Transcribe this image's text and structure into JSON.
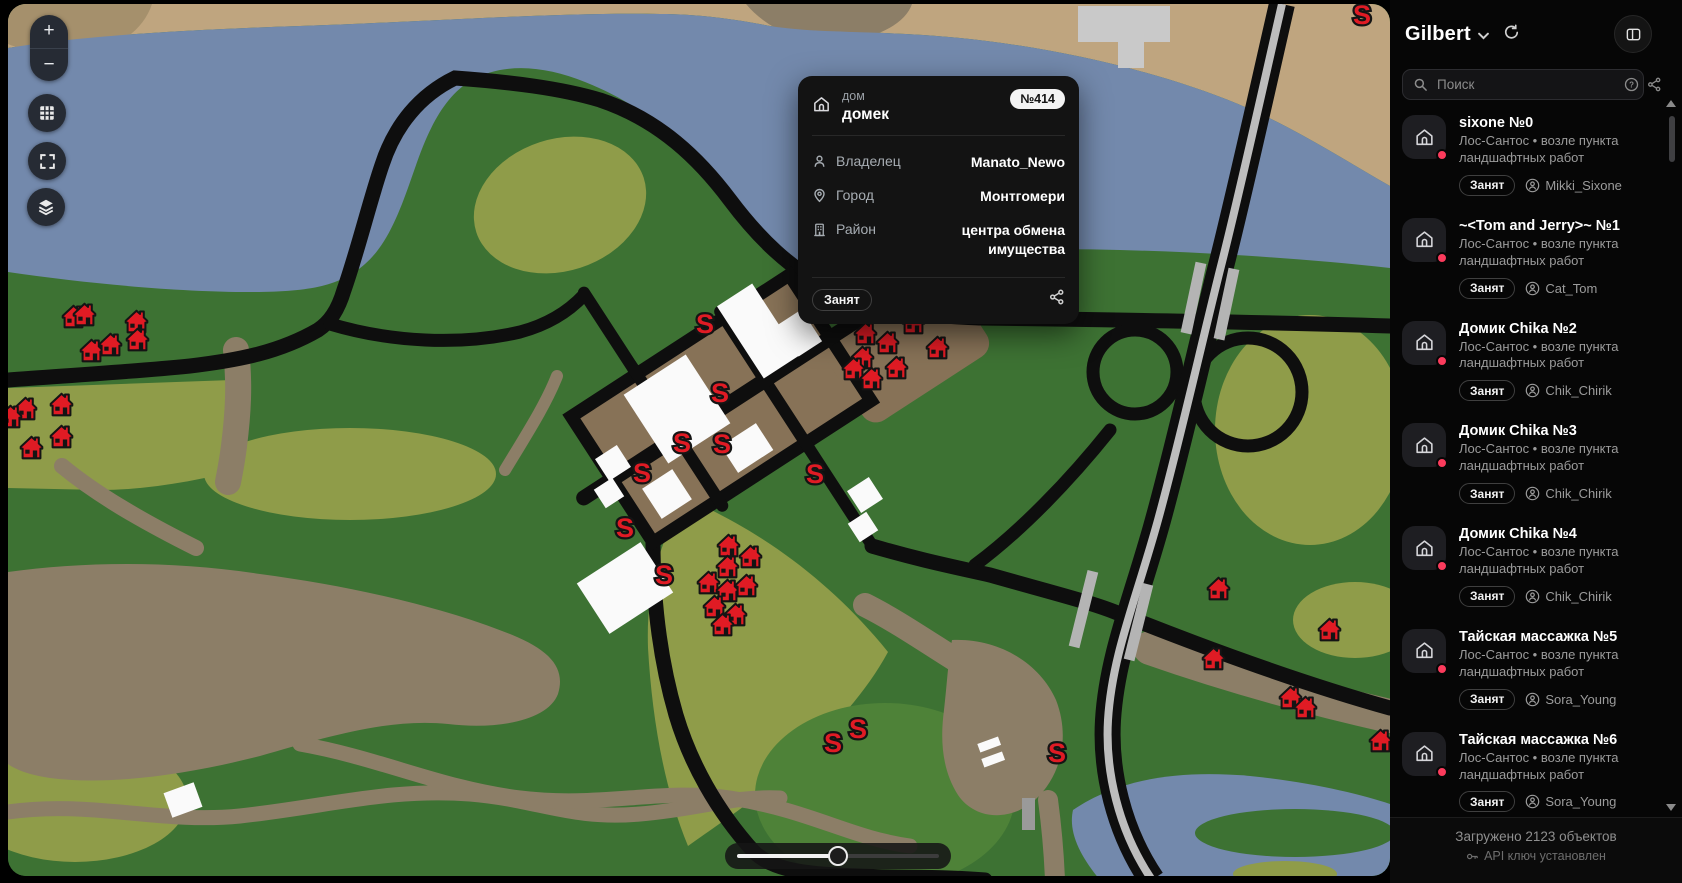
{
  "map": {
    "controls": {
      "zoom_in": "+",
      "zoom_out": "−",
      "grid_icon": "grid-icon",
      "fullscreen_icon": "fullscreen-icon",
      "layers_icon": "layers-icon"
    },
    "slider": {
      "progress_pct": 50
    },
    "colors": {
      "c-green": "#3d7233",
      "c-green2": "#4e8238",
      "c-olive": "#8f9c49",
      "c-water": "#7389ac",
      "c-tan": "#bfa57f",
      "c-tan2": "#a5906c",
      "c-dirt": "#8c7e67",
      "c-town": "#877257",
      "c-road": "#0e0e0e",
      "c-hwy": "#bdbdbd",
      "c-gray-bld": "#c9c9c9",
      "c-white-bld": "#fafafa",
      "c-red": "#e01b24",
      "c-dot": "#fb3b5c"
    },
    "s_label": "S",
    "s_markers": [
      [
        705,
        323
      ],
      [
        720,
        392
      ],
      [
        682,
        442
      ],
      [
        722,
        443
      ],
      [
        642,
        472
      ],
      [
        815,
        473
      ],
      [
        625,
        527
      ],
      [
        664,
        574
      ],
      [
        833,
        742
      ],
      [
        858,
        728
      ],
      [
        1057,
        752
      ],
      [
        1362,
        14
      ]
    ],
    "houses": [
      [
        73,
        316
      ],
      [
        84,
        314
      ],
      [
        136,
        321
      ],
      [
        91,
        350
      ],
      [
        110,
        344
      ],
      [
        137,
        339
      ],
      [
        25,
        408
      ],
      [
        61,
        404
      ],
      [
        61,
        436
      ],
      [
        31,
        447
      ],
      [
        10,
        416
      ],
      [
        728,
        545
      ],
      [
        750,
        556
      ],
      [
        727,
        566
      ],
      [
        708,
        582
      ],
      [
        727,
        590
      ],
      [
        746,
        585
      ],
      [
        714,
        606
      ],
      [
        735,
        614
      ],
      [
        722,
        624
      ],
      [
        865,
        333
      ],
      [
        887,
        342
      ],
      [
        862,
        357
      ],
      [
        853,
        368
      ],
      [
        871,
        378
      ],
      [
        896,
        367
      ],
      [
        913,
        322
      ],
      [
        937,
        347
      ],
      [
        1218,
        588
      ],
      [
        1213,
        658
      ],
      [
        1329,
        629
      ],
      [
        1290,
        697
      ],
      [
        1305,
        707
      ],
      [
        1380,
        740
      ]
    ]
  },
  "popup": {
    "type_label": "дом",
    "name": "домек",
    "number_badge": "№414",
    "rows": [
      {
        "label": "Владелец",
        "value": "Manato_Newo",
        "icon": "person-icon"
      },
      {
        "label": "Город",
        "value": "Монтгомери",
        "icon": "pin-icon"
      },
      {
        "label": "Район",
        "value": "центра обмена имущества",
        "icon": "building-icon"
      }
    ],
    "status_badge": "Занят"
  },
  "sidebar": {
    "title": "Gilbert",
    "search_placeholder": "Поиск",
    "items": [
      {
        "title": "sixone №0",
        "subtitle": "Лос-Сантос • возле пункта ландшафтных работ",
        "status": "Занят",
        "owner": "Mikki_Sixone"
      },
      {
        "title": "~<Tom and Jerry>~ №1",
        "subtitle": "Лос-Сантос • возле пункта ландшафтных работ",
        "status": "Занят",
        "owner": "Cat_Tom"
      },
      {
        "title": "Домик Chika №2",
        "subtitle": "Лос-Сантос • возле пункта ландшафтных работ",
        "status": "Занят",
        "owner": "Chik_Chirik"
      },
      {
        "title": "Домик Chika №3",
        "subtitle": "Лос-Сантос • возле пункта ландшафтных работ",
        "status": "Занят",
        "owner": "Chik_Chirik"
      },
      {
        "title": "Домик Chika №4",
        "subtitle": "Лос-Сантос • возле пункта ландшафтных работ",
        "status": "Занят",
        "owner": "Chik_Chirik"
      },
      {
        "title": "Тайская массажка №5",
        "subtitle": "Лос-Сантос • возле пункта ландшафтных работ",
        "status": "Занят",
        "owner": "Sora_Young"
      },
      {
        "title": "Тайская массажка №6",
        "subtitle": "Лос-Сантос • возле пункта ландшафтных работ",
        "status": "Занят",
        "owner": "Sora_Young"
      },
      {
        "title": "Тайская массажка №7",
        "subtitle": "Лос-Сантос • возле пункта ландшафтных работ",
        "status": null,
        "owner": null
      }
    ],
    "footer": {
      "loaded": "Загружено 2123 объектов",
      "api": "API ключ установлен"
    }
  }
}
